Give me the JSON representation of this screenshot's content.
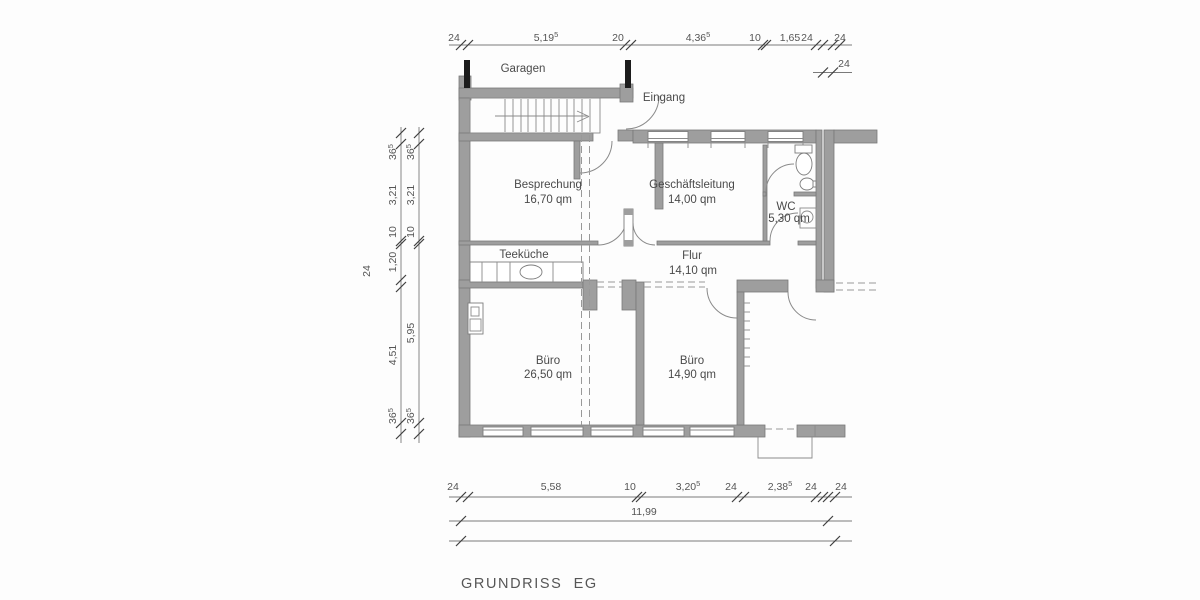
{
  "title": "GRUNDRISS  EG",
  "labels": {
    "garage": "Garagen",
    "entrance": "Eingang"
  },
  "rooms": {
    "besprechung": {
      "name": "Besprechung",
      "area": "16,70 qm"
    },
    "geschaeftsleitung": {
      "name": "Geschäftsleitung",
      "area": "14,00 qm"
    },
    "wc": {
      "name": "WC",
      "area": "5,30 qm"
    },
    "flur": {
      "name": "Flur",
      "area": "14,10 qm"
    },
    "teekueche": {
      "name": "Teeküche"
    },
    "buero_gross": {
      "name": "Büro",
      "area": "26,50 qm"
    },
    "buero_klein": {
      "name": "Büro",
      "area": "14,90 qm"
    }
  },
  "dimensions": {
    "top": [
      {
        "v": "24"
      },
      {
        "v": "5,19",
        "sup": "5"
      },
      {
        "v": "20"
      },
      {
        "v": "4,36",
        "sup": "5"
      },
      {
        "v": "10"
      },
      {
        "v": "1,65"
      },
      {
        "v": "24"
      },
      {
        "v": "24"
      }
    ],
    "top_offset": {
      "v": "24"
    },
    "bottom": [
      {
        "v": "24"
      },
      {
        "v": "5,58"
      },
      {
        "v": "10"
      },
      {
        "v": "3,20",
        "sup": "5"
      },
      {
        "v": "24"
      },
      {
        "v": "2,38",
        "sup": "5"
      },
      {
        "v": "24"
      },
      {
        "v": "24"
      }
    ],
    "bottom_total": {
      "v": "11,99"
    },
    "left_outer": [
      {
        "v": "36",
        "sup": "5"
      },
      {
        "v": "3,21"
      },
      {
        "v": "10"
      },
      {
        "v": "1,20"
      },
      {
        "v": "24"
      },
      {
        "v": "4,51"
      },
      {
        "v": "36",
        "sup": "5"
      }
    ],
    "left_inner": [
      {
        "v": "36",
        "sup": "5"
      },
      {
        "v": "3,21"
      },
      {
        "v": "10"
      },
      {
        "v": "5,95"
      },
      {
        "v": "36",
        "sup": "5"
      }
    ]
  },
  "colors": {
    "wall": "#9e9e9e",
    "wall_edge": "#787878",
    "column": "#1c1c1c",
    "dim_text": "#555555",
    "text": "#4a4a4a"
  }
}
